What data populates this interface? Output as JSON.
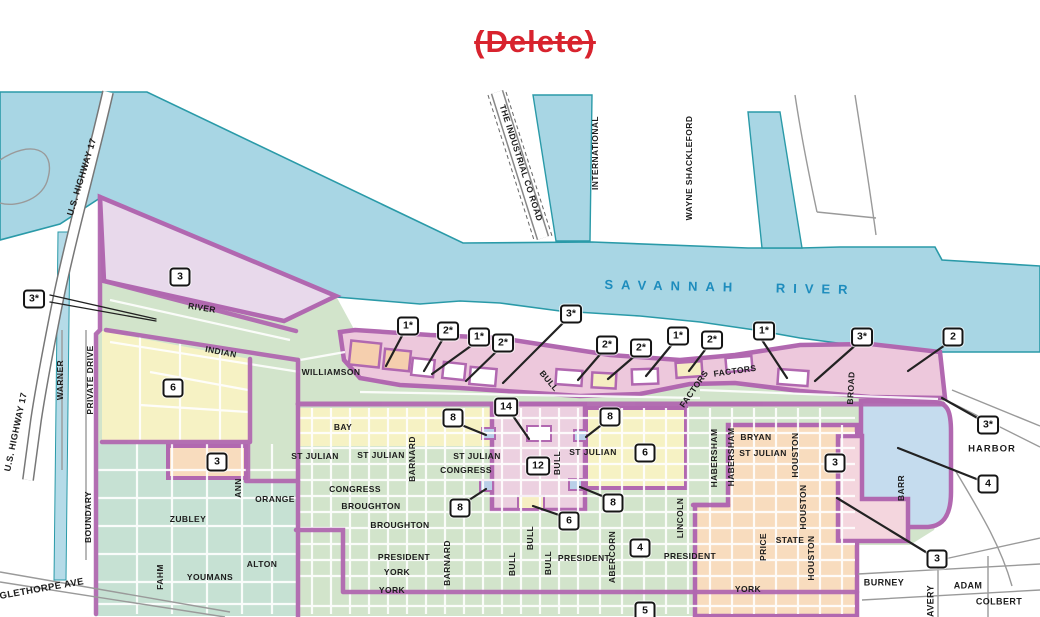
{
  "page": {
    "delete_annotation": "(Delete)"
  },
  "map": {
    "river_label": "SAVANNAH RIVER",
    "colors": {
      "river": "#a8d6e4",
      "shore_stroke": "#2a9aa8",
      "district_boundary_purple": "#b168b0",
      "zone_green": "#d2e4cb",
      "zone_teal_green": "#c6e1d3",
      "zone_lavender": "#e8d9eb",
      "zone_yellow": "#f6f2c4",
      "zone_peach": "#f8dcbe",
      "zone_pink": "#edc8dc",
      "zone_blue": "#c5dcee",
      "annotation_red": "#d8232e",
      "river_text_blue": "#1d8cbd"
    },
    "street_labels": [
      {
        "text": "U.S. HIGHWAY 17",
        "x": 82,
        "y": 177,
        "r": -73,
        "fs": 9
      },
      {
        "text": "U.S. HIGHWAY 17",
        "x": 16,
        "y": 432,
        "r": -78,
        "fs": 9
      },
      {
        "text": "WARNER",
        "x": 60,
        "y": 380,
        "r": -90
      },
      {
        "text": "PRIVATE DRIVE",
        "x": 90,
        "y": 380,
        "r": -90
      },
      {
        "text": "BOUNDARY",
        "x": 88,
        "y": 517,
        "r": -90
      },
      {
        "text": "OGLETHORPE AVE",
        "x": 38,
        "y": 590,
        "r": -10,
        "fs": 9.5
      },
      {
        "text": "FAHM",
        "x": 160,
        "y": 577,
        "r": -90
      },
      {
        "text": "ZUBLEY",
        "x": 188,
        "y": 519,
        "r": 0
      },
      {
        "text": "YOUMANS",
        "x": 210,
        "y": 577,
        "r": 0
      },
      {
        "text": "ALTON",
        "x": 262,
        "y": 564,
        "r": 0
      },
      {
        "text": "ORANGE",
        "x": 275,
        "y": 499,
        "r": 0
      },
      {
        "text": "ANN",
        "x": 238,
        "y": 488,
        "r": -90
      },
      {
        "text": "RIVER",
        "x": 202,
        "y": 308,
        "r": 9
      },
      {
        "text": "INDIAN",
        "x": 221,
        "y": 352,
        "r": 11
      },
      {
        "text": "WILLIAMSON",
        "x": 331,
        "y": 372,
        "r": 0
      },
      {
        "text": "BAY",
        "x": 343,
        "y": 427,
        "r": 0
      },
      {
        "text": "THE INDUSTRIAL CO ROAD",
        "x": 521,
        "y": 163,
        "r": 72
      },
      {
        "text": "INTERNATIONAL",
        "x": 595,
        "y": 153,
        "r": -90
      },
      {
        "text": "WAYNE SHACKLEFORD",
        "x": 689,
        "y": 168,
        "r": -90
      },
      {
        "text": "BULL",
        "x": 549,
        "y": 381,
        "r": 50
      },
      {
        "text": "FACTORS",
        "x": 694,
        "y": 389,
        "r": -55
      },
      {
        "text": "FACTORS",
        "x": 735,
        "y": 371,
        "r": -8
      },
      {
        "text": "BROAD",
        "x": 851,
        "y": 388,
        "r": -87
      },
      {
        "text": "ST JULIAN",
        "x": 315,
        "y": 456,
        "r": 0
      },
      {
        "text": "ST JULIAN",
        "x": 381,
        "y": 455,
        "r": 0
      },
      {
        "text": "ST JULIAN",
        "x": 477,
        "y": 456,
        "r": 0
      },
      {
        "text": "ST JULIAN",
        "x": 593,
        "y": 452,
        "r": 0
      },
      {
        "text": "ST JULIAN",
        "x": 763,
        "y": 453,
        "r": 0
      },
      {
        "text": "CONGRESS",
        "x": 466,
        "y": 470,
        "r": 0
      },
      {
        "text": "CONGRESS",
        "x": 355,
        "y": 489,
        "r": 0
      },
      {
        "text": "BROUGHTON",
        "x": 371,
        "y": 506,
        "r": 0
      },
      {
        "text": "BROUGHTON",
        "x": 400,
        "y": 525,
        "r": 0
      },
      {
        "text": "PRESIDENT",
        "x": 404,
        "y": 557,
        "r": 0
      },
      {
        "text": "PRESIDENT",
        "x": 584,
        "y": 558,
        "r": 0
      },
      {
        "text": "PRESIDENT",
        "x": 690,
        "y": 556,
        "r": 0
      },
      {
        "text": "YORK",
        "x": 397,
        "y": 572,
        "r": 0
      },
      {
        "text": "YORK",
        "x": 392,
        "y": 590,
        "r": 0
      },
      {
        "text": "YORK",
        "x": 748,
        "y": 589,
        "r": 0
      },
      {
        "text": "BARNARD",
        "x": 412,
        "y": 459,
        "r": -90
      },
      {
        "text": "BARNARD",
        "x": 447,
        "y": 563,
        "r": -90
      },
      {
        "text": "BULL",
        "x": 557,
        "y": 463,
        "r": -90
      },
      {
        "text": "BULL",
        "x": 530,
        "y": 538,
        "r": -90
      },
      {
        "text": "BULL",
        "x": 512,
        "y": 564,
        "r": -90
      },
      {
        "text": "BULL",
        "x": 548,
        "y": 563,
        "r": -90
      },
      {
        "text": "ABERCORN",
        "x": 612,
        "y": 557,
        "r": -90
      },
      {
        "text": "LINCOLN",
        "x": 680,
        "y": 518,
        "r": -90
      },
      {
        "text": "HABERSHAM",
        "x": 714,
        "y": 458,
        "r": -90
      },
      {
        "text": "HABERSHAM",
        "x": 731,
        "y": 457,
        "r": -90
      },
      {
        "text": "BRYAN",
        "x": 756,
        "y": 437,
        "r": 0
      },
      {
        "text": "HOUSTON",
        "x": 795,
        "y": 455,
        "r": -90
      },
      {
        "text": "HOUSTON",
        "x": 803,
        "y": 507,
        "r": -90
      },
      {
        "text": "HOUSTON",
        "x": 811,
        "y": 558,
        "r": -90
      },
      {
        "text": "PRICE",
        "x": 763,
        "y": 547,
        "r": -90
      },
      {
        "text": "STATE",
        "x": 790,
        "y": 540,
        "r": 0
      },
      {
        "text": "HARBOR",
        "x": 992,
        "y": 449,
        "r": 0,
        "fs": 9.5,
        "ls": 1
      },
      {
        "text": "BARR",
        "x": 901,
        "y": 488,
        "r": -90
      },
      {
        "text": "BURNEY",
        "x": 884,
        "y": 583,
        "r": 0,
        "fs": 9
      },
      {
        "text": "AVERY",
        "x": 931,
        "y": 601,
        "r": -90,
        "fs": 9
      },
      {
        "text": "ADAM",
        "x": 968,
        "y": 586,
        "r": 0,
        "fs": 9
      },
      {
        "text": "COLBERT",
        "x": 999,
        "y": 602,
        "r": 0,
        "fs": 9
      }
    ],
    "zone_badges": [
      {
        "label": "3",
        "x": 180,
        "y": 277
      },
      {
        "label": "3*",
        "x": 34,
        "y": 299
      },
      {
        "label": "6",
        "x": 173,
        "y": 388
      },
      {
        "label": "3",
        "x": 217,
        "y": 462
      },
      {
        "label": "1*",
        "x": 408,
        "y": 326
      },
      {
        "label": "2*",
        "x": 448,
        "y": 331
      },
      {
        "label": "1*",
        "x": 479,
        "y": 337
      },
      {
        "label": "2*",
        "x": 503,
        "y": 343
      },
      {
        "label": "3*",
        "x": 571,
        "y": 314
      },
      {
        "label": "2*",
        "x": 607,
        "y": 345
      },
      {
        "label": "2*",
        "x": 641,
        "y": 348
      },
      {
        "label": "1*",
        "x": 678,
        "y": 336
      },
      {
        "label": "2*",
        "x": 712,
        "y": 340
      },
      {
        "label": "1*",
        "x": 764,
        "y": 331
      },
      {
        "label": "3*",
        "x": 862,
        "y": 337
      },
      {
        "label": "2",
        "x": 953,
        "y": 337
      },
      {
        "label": "3*",
        "x": 988,
        "y": 425
      },
      {
        "label": "8",
        "x": 453,
        "y": 418
      },
      {
        "label": "14",
        "x": 506,
        "y": 407
      },
      {
        "label": "8",
        "x": 610,
        "y": 417
      },
      {
        "label": "12",
        "x": 538,
        "y": 466
      },
      {
        "label": "6",
        "x": 645,
        "y": 453
      },
      {
        "label": "8",
        "x": 460,
        "y": 508
      },
      {
        "label": "8",
        "x": 613,
        "y": 503
      },
      {
        "label": "6",
        "x": 569,
        "y": 521
      },
      {
        "label": "4",
        "x": 640,
        "y": 548
      },
      {
        "label": "5",
        "x": 645,
        "y": 611
      },
      {
        "label": "3",
        "x": 835,
        "y": 463
      },
      {
        "label": "4",
        "x": 988,
        "y": 484
      },
      {
        "label": "3",
        "x": 937,
        "y": 559
      }
    ]
  }
}
